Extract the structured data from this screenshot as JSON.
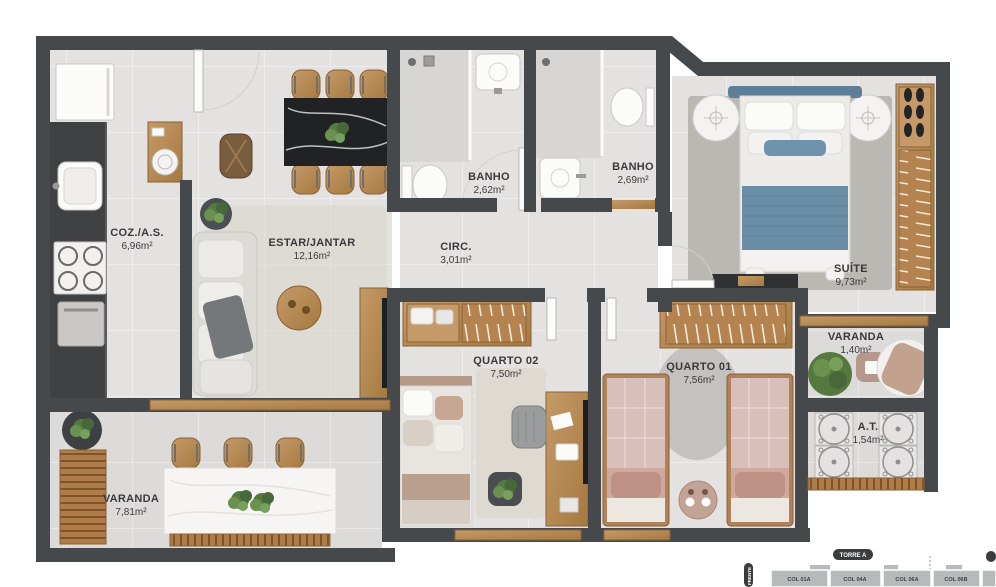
{
  "plan": {
    "rooms": [
      {
        "id": "cozinha",
        "name": "COZ./A.S.",
        "area": "6,96m²"
      },
      {
        "id": "estar-jantar",
        "name": "ESTAR/JANTAR",
        "area": "12,16m²"
      },
      {
        "id": "banho-1",
        "name": "BANHO",
        "area": "2,62m²"
      },
      {
        "id": "banho-2",
        "name": "BANHO",
        "area": "2,69m²"
      },
      {
        "id": "circulacao",
        "name": "CIRC.",
        "area": "3,01m²"
      },
      {
        "id": "suite",
        "name": "SUÍTE",
        "area": "9,73m²"
      },
      {
        "id": "varanda-suite",
        "name": "VARANDA",
        "area": "1,40m²"
      },
      {
        "id": "quarto-02",
        "name": "QUARTO 02",
        "area": "7,50m²"
      },
      {
        "id": "quarto-01",
        "name": "QUARTO 01",
        "area": "7,56m²"
      },
      {
        "id": "area-tecnica",
        "name": "A.T.",
        "area": "1,54m²"
      },
      {
        "id": "varanda",
        "name": "VARANDA",
        "area": "7,81m²"
      }
    ]
  },
  "keyplan": {
    "tower_label": "TORRE A",
    "side_label": "FRENTE",
    "units": [
      "COL 01A",
      "COL 04A",
      "COL 06A",
      "COL 06B"
    ]
  },
  "colors": {
    "wall": "#46494c",
    "floor": "#e3e2e0",
    "wood": "#b5834f",
    "bed_blue": "#6b8ea7",
    "bed_pink": "#d9bfba",
    "marble_dark": "#202224"
  }
}
